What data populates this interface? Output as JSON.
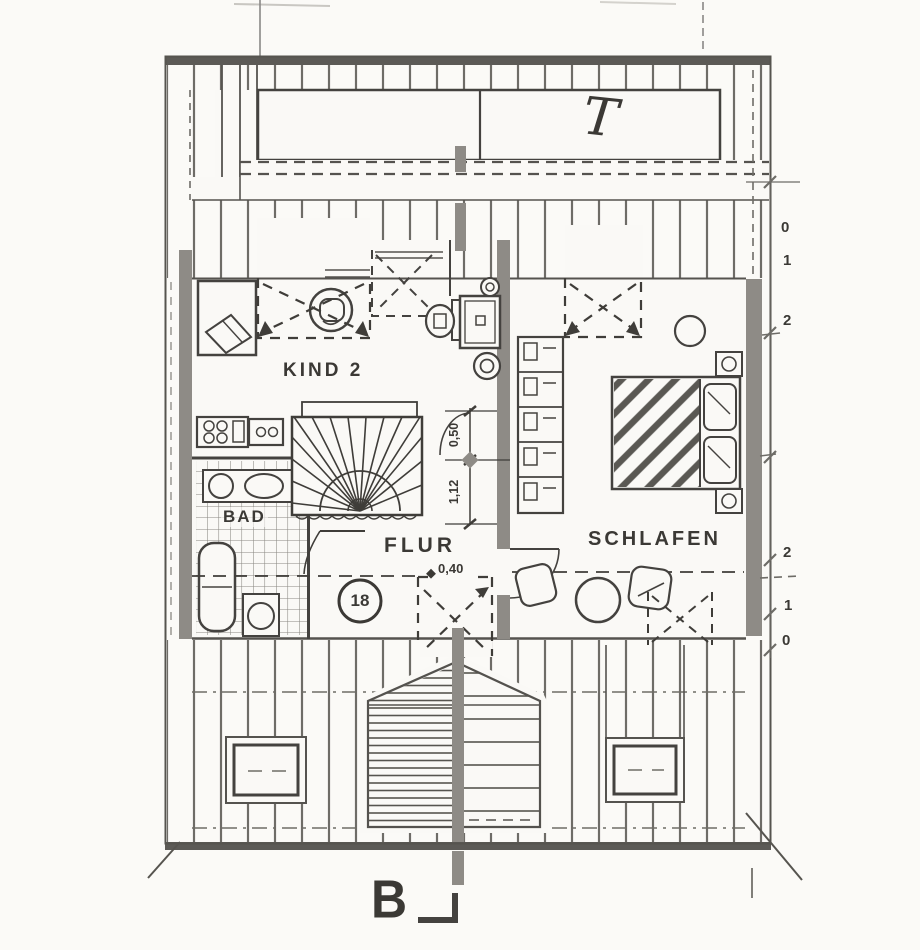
{
  "plan": {
    "title_mark": "T",
    "rooms": {
      "kind2": "KIND 2",
      "flur": "FLUR",
      "schlafen": "SCHLAFEN",
      "bad": "BAD"
    },
    "annotations": {
      "position_number": "18",
      "sill_height": "0,40",
      "dim_upper": "0,50",
      "dim_lower": "1,12",
      "section_letter": "B"
    },
    "edge_dimensions": [
      "0",
      "1",
      "2",
      "2",
      "1",
      "0"
    ],
    "colors": {
      "paper": "#faf9f6",
      "ink": "#3b3935",
      "wall_gray": "#8e8b86",
      "hatch": "#6e6c67"
    }
  }
}
